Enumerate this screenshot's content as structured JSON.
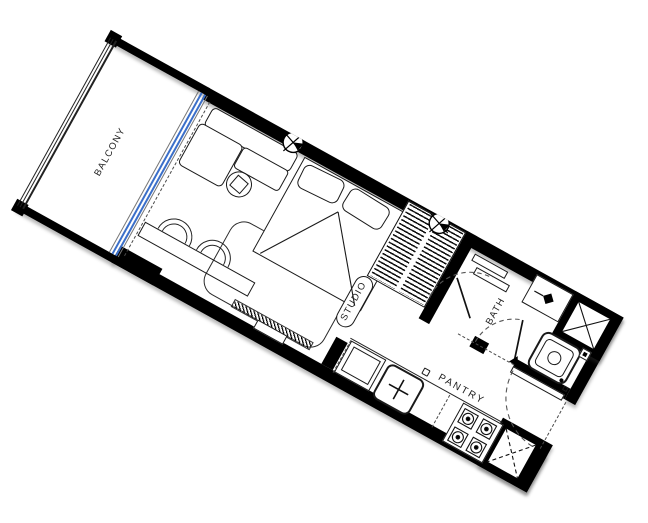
{
  "labels": {
    "balcony": "BALCONY",
    "studio": "STUDIO",
    "bath": "BATH",
    "pantry": "PANTRY"
  },
  "colors": {
    "wall": "#000000",
    "line": "#1a1a1a",
    "dash": "#4a4a4a",
    "blue": "#3b6fc9",
    "bg": "#ffffff",
    "text": "#1f1f1f"
  },
  "rooms": [
    {
      "name": "BALCONY",
      "fixtures": [
        "railing",
        "corner-columns",
        "sliding-glass-door"
      ]
    },
    {
      "name": "STUDIO",
      "fixtures": [
        "sofa",
        "side-table",
        "rug",
        "desk",
        "chairs",
        "double-bed",
        "pillows",
        "tv-unit",
        "wardrobe",
        "ceiling-fixture-symbols"
      ]
    },
    {
      "name": "BATH",
      "fixtures": [
        "shower",
        "shower-shelves",
        "shower-door",
        "valve-box",
        "washbasin",
        "accessories",
        "service-shaft",
        "bath-door"
      ]
    },
    {
      "name": "PANTRY",
      "fixtures": [
        "counter",
        "under-counter-appliance",
        "sink",
        "cooktop-4-burner",
        "service-shaft",
        "entry-door"
      ]
    }
  ]
}
